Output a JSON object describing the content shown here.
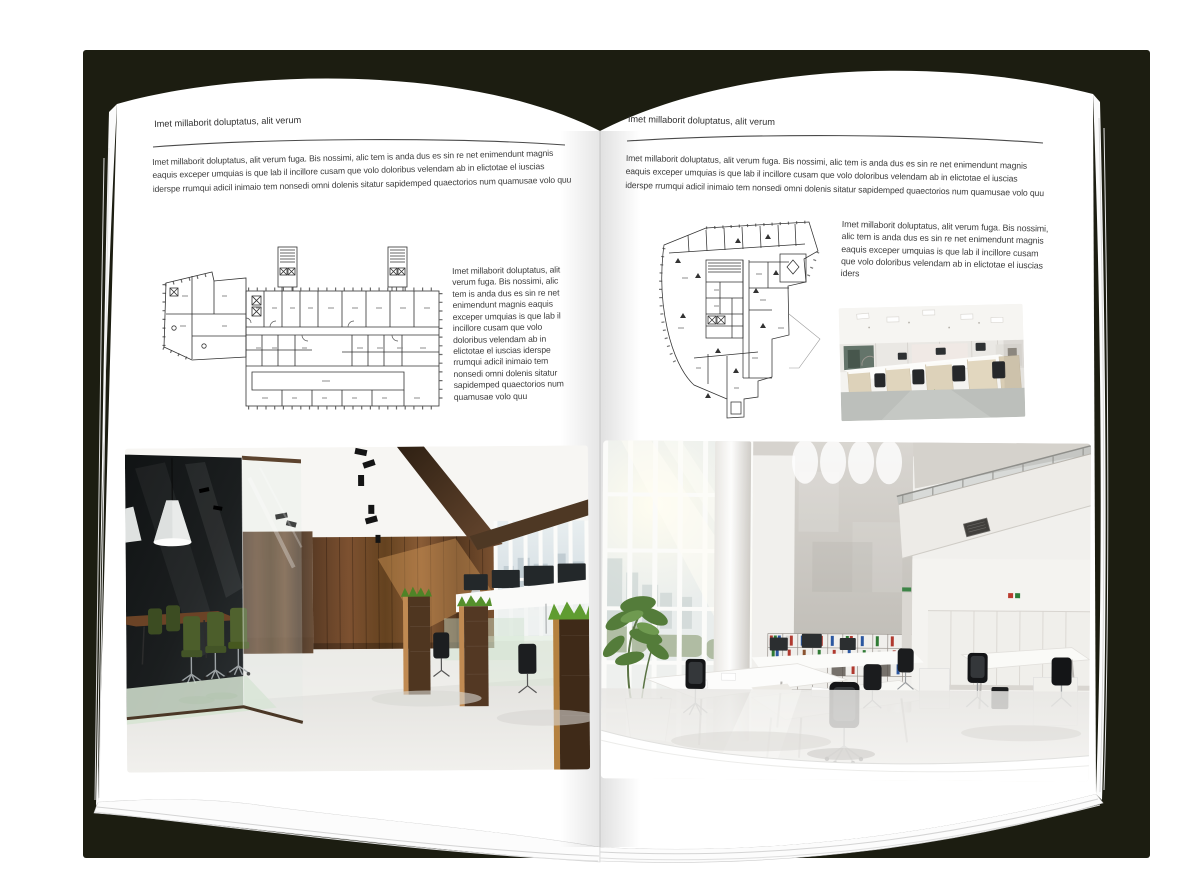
{
  "colors": {
    "backdrop_shadow": "#1c1d11",
    "page": "#ffffff",
    "body_text": "#3d3d3d",
    "rule": "#4b4b4b"
  },
  "left_page": {
    "header": "Imet millaborit doluptatus, alit verum",
    "intro": "Imet millaborit doluptatus, alit verum fuga. Bis nossimi, alic tem is anda dus es sin re net enimendunt magnis eaquis exceper umquias is que lab il incillore cusam que volo doloribus velendam ab in elictotae el iuscias iderspe rrumqui adicil inimaio tem nonsedi omni dolenis sitatur sapidemped quaectorios num quamusae volo quu",
    "side_text": "Imet millaborit doluptatus, alit verum fuga. Bis nossimi, alic tem is anda dus es sin re net enimendunt magnis eaquis exceper umquias is que lab il incillore cusam que volo doloribus velendam ab in elictotae el iuscias iderspe rrumqui adicil inimaio tem nonsedi omni dolenis sitatur sapidemped quaectorios num quamusae volo quu"
  },
  "right_page": {
    "header": "Imet millaborit doluptatus, alit verum",
    "intro": "Imet millaborit doluptatus, alit verum fuga. Bis nossimi, alic tem is anda dus es sin re net enimendunt magnis eaquis exceper umquias is que lab il incillore cusam que volo doloribus velendam ab in elictotae el iuscias iderspe rrumqui adicil inimaio tem nonsedi omni dolenis sitatur sapidemped quaectorios num quamusae volo quu",
    "side_text": "Imet millaborit doluptatus, alit verum fuga. Bis nossimi, alic tem is anda dus es sin re net enimendunt magnis eaquis exceper umquias is que lab il incillore cusam que volo doloribus velendam ab in elictotae el iuscias iders"
  }
}
